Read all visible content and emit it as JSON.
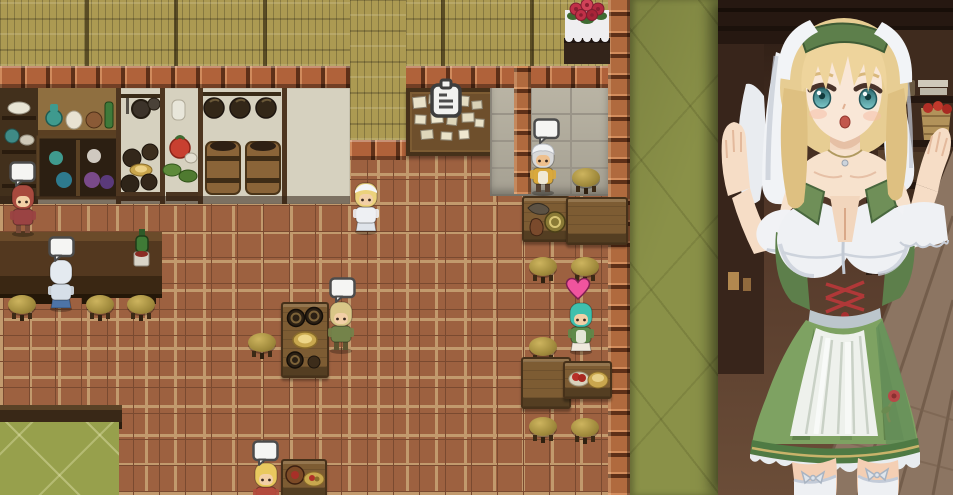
{
  "meta": {
    "scene": "tavern-interior-rpg-map-with-waitress-portrait",
    "map_size": {
      "width": 718,
      "height": 495
    },
    "portrait_size": {
      "width": 235,
      "height": 495
    }
  },
  "palette": {
    "floor_tile": "#9d6140",
    "tile_grout": "#c29a6d",
    "woven_wall": "#ac9a52",
    "brick": "#b0623a",
    "stone_wall": "#c9c3b2",
    "green_wall": "#8a9148",
    "green_floor": "#97a04c",
    "counter_wood": "#53381f",
    "table_wood": "#7d5c33",
    "speech_bubble": "#f5f5f3",
    "heart": "#f0549e"
  },
  "indicator_legend": {
    "bubble": "empty white speech bubble above NPC",
    "heart": "pink heart above NPC",
    "notice": "white clipboard icon above bulletin board"
  },
  "map": {
    "characters": [
      {
        "id": "npc-redhead-villager",
        "x": 8,
        "y": 183,
        "hair": "#a84a3e",
        "body": "#9a4343",
        "legs": "#7a4a38",
        "skin": "#f2cfa6",
        "headgear": "none",
        "back": false,
        "skirt": false,
        "apron": false,
        "indicator": {
          "type": "bubble",
          "x": 9,
          "y": 161
        }
      },
      {
        "id": "npc-patron-blue",
        "x": 46,
        "y": 258,
        "hair": "#e4eaf0",
        "body": "#d6dfe8",
        "legs": "#4d74a8",
        "skin": "#f2cfa6",
        "headgear": "none",
        "back": true,
        "skirt": true,
        "apron": false,
        "indicator": {
          "type": "bubble",
          "x": 48,
          "y": 236
        }
      },
      {
        "id": "npc-waitress-sprite",
        "x": 351,
        "y": 181,
        "hair": "#ecd27c",
        "body": "#eef0f3",
        "legs": "#dfe4ea",
        "skin": "#f2cfa6",
        "headgear": "kerchief",
        "back": false,
        "skirt": true,
        "apron": false,
        "indicator": null
      },
      {
        "id": "npc-chef",
        "x": 528,
        "y": 142,
        "hair": "#d8d8d8",
        "body": "#d9a93c",
        "legs": "#554232",
        "skin": "#eec08e",
        "headgear": "turban",
        "back": false,
        "skirt": false,
        "apron": true,
        "indicator": {
          "type": "bubble",
          "x": 533,
          "y": 118
        }
      },
      {
        "id": "npc-man-green",
        "x": 326,
        "y": 300,
        "hair": "#d9c687",
        "body": "#74834a",
        "legs": "#5c5430",
        "skin": "#f2cfa6",
        "headgear": "none",
        "back": false,
        "skirt": false,
        "apron": false,
        "indicator": {
          "type": "bubble",
          "x": 329,
          "y": 277
        }
      },
      {
        "id": "npc-girl-teal",
        "x": 566,
        "y": 301,
        "hair": "#3ec0ad",
        "body": "#5f8a4a",
        "legs": "#efe9dd",
        "skin": "#f2cfa6",
        "headgear": "none",
        "back": false,
        "skirt": true,
        "apron": true,
        "indicator": {
          "type": "heart",
          "x": 565,
          "y": 277
        }
      },
      {
        "id": "npc-child-blonde",
        "x": 251,
        "y": 461,
        "hair": "#e9c95f",
        "body": "#b34a3c",
        "legs": "#8a5a3a",
        "skin": "#f2cfa6",
        "headgear": "none",
        "back": false,
        "skirt": false,
        "apron": false,
        "indicator": {
          "type": "bubble",
          "x": 252,
          "y": 440
        }
      }
    ],
    "stools": [
      {
        "x": 7,
        "y": 293
      },
      {
        "x": 85,
        "y": 293
      },
      {
        "x": 126,
        "y": 293
      },
      {
        "x": 247,
        "y": 331
      },
      {
        "x": 528,
        "y": 255
      },
      {
        "x": 570,
        "y": 255
      },
      {
        "x": 528,
        "y": 335
      },
      {
        "x": 528,
        "y": 415
      },
      {
        "x": 570,
        "y": 416
      },
      {
        "x": 571,
        "y": 166
      }
    ],
    "tables": [
      {
        "id": "table-tankards",
        "x": 281,
        "y": 302,
        "w": 44,
        "h": 72,
        "items": "tankards"
      },
      {
        "id": "table-chef-pot",
        "x": 522,
        "y": 196,
        "w": 44,
        "h": 42,
        "items": "pot"
      },
      {
        "id": "table-chef-side",
        "x": 566,
        "y": 197,
        "w": 58,
        "h": 44,
        "items": "none"
      },
      {
        "id": "table-square",
        "x": 521,
        "y": 357,
        "w": 46,
        "h": 48,
        "items": "none"
      },
      {
        "id": "table-food",
        "x": 563,
        "y": 361,
        "w": 45,
        "h": 34,
        "items": "food"
      },
      {
        "id": "table-cask",
        "x": 281,
        "y": 459,
        "w": 42,
        "h": 36,
        "items": "cask"
      }
    ],
    "props": {
      "bulletin_board": {
        "x": 406,
        "y": 88,
        "w": 84,
        "h": 60
      },
      "notice_icon": {
        "x": 427,
        "y": 78
      },
      "roses_table": {
        "x": 564,
        "y": 0
      },
      "counter": {
        "x": 0,
        "y": 232,
        "w": 162,
        "h": 62
      },
      "counter_drinks": {
        "x": 128,
        "y": 228
      }
    }
  },
  "portrait": {
    "subject": "blonde waitress in green dirndl with white head veil, arms raised",
    "hair": "#eed49c",
    "eyes": "#3f8f93",
    "veil": "#f1f3f6",
    "dress_green": "#7ea262",
    "apron": "#eef1ec",
    "lacing_red": "#b03838",
    "stockings": "#eef0f3",
    "background_wood": "#5e4230"
  }
}
